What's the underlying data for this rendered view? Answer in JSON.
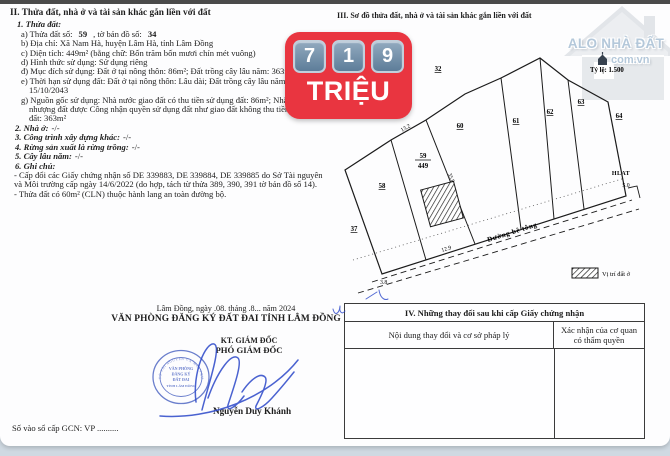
{
  "badge": {
    "digits": [
      "7",
      "1",
      "9"
    ],
    "unit": "TRIỆU",
    "bg_color": "#e93540",
    "keycap_color": "#6d89a3"
  },
  "logo": {
    "title": "ALO NHÀ ĐẤT",
    "domain": "com.vn"
  },
  "section2": {
    "title": "II. Thửa đất, nhà ở và tài sản khác gắn liền với đất",
    "sub1": "1. Thửa đất:",
    "line_a": {
      "t1": "a) Thửa đất số:",
      "v1": "59",
      "t2": ", tờ bản đồ số:",
      "v2": "34"
    },
    "lines": [
      "b) Địa chỉ: Xã Nam Hà, huyện Lâm Hà, tỉnh Lâm Đồng",
      "c) Diện tích: 449m² (bằng chữ: Bốn trăm bốn mươi chín mét vuông)",
      "d) Hình thức sử dụng: Sử dụng riêng",
      "đ) Mục đích sử dụng: Đất ở tại nông thôn: 86m²; Đất trồng cây lâu năm: 363m²",
      "e) Thời hạn sử dụng đất: Đất ở tại nông thôn: Lâu dài; Đất trồng cây lâu năm: 15/10/2043",
      "g) Nguồn gốc sử dụng: Nhà nước giao đất có thu tiền sử dụng đất: 86m²; Nhận chuyển nhượng đất được Công nhận quyền sử dụng đất như giao đất không thu tiền sử dụng đất: 363m²"
    ],
    "numbered": [
      {
        "label": "2. Nhà ở:",
        "value": "-/-"
      },
      {
        "label": "3. Công trình xây dựng khác:",
        "value": "-/-"
      },
      {
        "label": "4. Rừng sản xuất là rừng trồng:",
        "value": "-/-"
      },
      {
        "label": "5. Cây lâu năm:",
        "value": "-/-"
      },
      {
        "label": "6. Ghi chú:",
        "value": ""
      }
    ],
    "notes": [
      "- Cấp đổi các Giấy chứng nhận số DE 339883, DE 339884, DE 339885 do Sở Tài nguyên và Môi trường cấp ngày 14/6/2022 (do hợp, tách từ thửa 389, 390, 391 tờ bản đồ số 14).",
      "- Thửa đất có 60m² (CLN) thuộc hành lang an toàn đường bộ."
    ]
  },
  "sig": {
    "date_line": "Lâm Đồng, ngày .08. tháng .8... năm 2024",
    "office": "VĂN PHÒNG ĐĂNG KÝ ĐẤT ĐAI TỈNH LÂM ĐỒNG",
    "kt": "KT. GIÁM ĐỐC",
    "deputy": "PHÓ GIÁM ĐỐC",
    "signer": "Nguyễn Duy Khánh",
    "stamp_ring": "SỞ TÀI NGUYÊN VÀ MÔI TRƯỜNG",
    "stamp_lines": [
      "VĂN PHÒNG",
      "ĐĂNG KÝ",
      "ĐẤT ĐAI",
      "TỈNH LÂM ĐỒNG"
    ],
    "gcn_line": "Số vào sổ cấp GCN: VP .........."
  },
  "section3": {
    "title": "III. Sơ đồ thửa đất, nhà ở và tài sản khác gắn liền với đất",
    "scale": "Tỷ lệ: 1.500",
    "map": {
      "parcels": {
        "p32": "32",
        "p37": "37",
        "p58": "58",
        "p59": "59",
        "p59_area": "449",
        "p60": "60",
        "p61": "61",
        "p62": "62",
        "p63": "63",
        "p64": "64"
      },
      "measures": {
        "m132": "13.2",
        "m358": "35.8",
        "m129": "12.9",
        "m38": "3.8",
        "m50": "5.0",
        "hlat": "HLAT"
      },
      "road": "Đường bê tông",
      "legend": "Vị trí đất ở"
    }
  },
  "section4": {
    "title": "IV. Những thay đổi sau khi cấp Giấy chứng nhận",
    "col1": "Nội dung thay đổi và cơ sở pháp lý",
    "col2": "Xác nhận của cơ quan có thẩm quyền"
  }
}
